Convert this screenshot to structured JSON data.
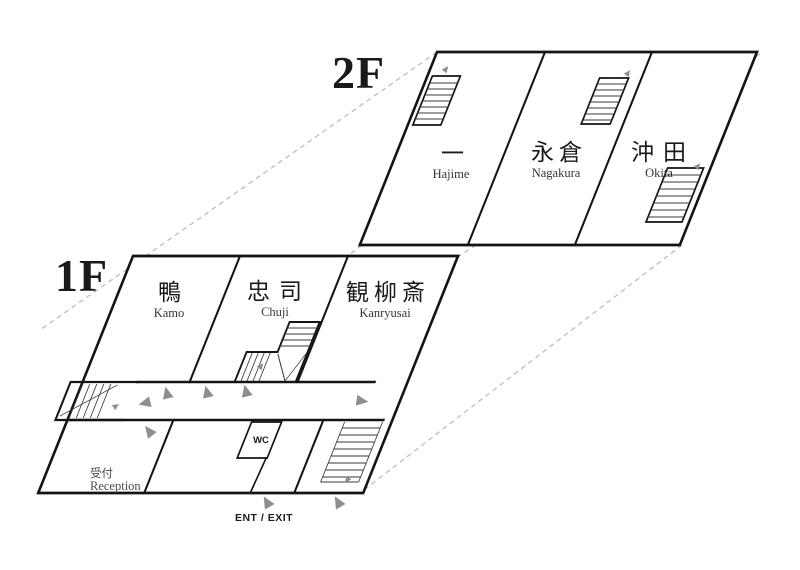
{
  "diagram_title": "Two-storey floor plan",
  "floors": {
    "f2": {
      "label": "2F",
      "rooms": [
        {
          "kanji": "一",
          "romaji": "Hajime"
        },
        {
          "kanji": "永倉",
          "romaji": "Nagakura"
        },
        {
          "kanji": "沖田",
          "romaji": "Okita"
        }
      ]
    },
    "f1": {
      "label": "1F",
      "rooms": [
        {
          "kanji": "鴨",
          "romaji": "Kamo"
        },
        {
          "kanji": "忠司",
          "romaji": "Chuji"
        },
        {
          "kanji": "観柳斎",
          "romaji": "Kanryusai"
        }
      ],
      "reception": {
        "kanji": "受付",
        "romaji": "Reception"
      },
      "wc_label": "WC",
      "entrance_label": "ENT / EXIT"
    }
  },
  "icons": {
    "stairs": "stairs-icon",
    "direction_arrow": "direction-arrow-icon",
    "stair_direction_arrow": "stair-direction-arrow-icon",
    "projection_line": "dashed-projection-line"
  },
  "colors": {
    "background": "#ffffff",
    "wall": "#141414",
    "stair_tread": "#3a3a3a",
    "dashed_line": "#b9b9b9",
    "arrow": "#8e8e8e",
    "text": "#1a1a1a",
    "romaji_text": "#353535",
    "reception_text": "#4a4a4a"
  }
}
